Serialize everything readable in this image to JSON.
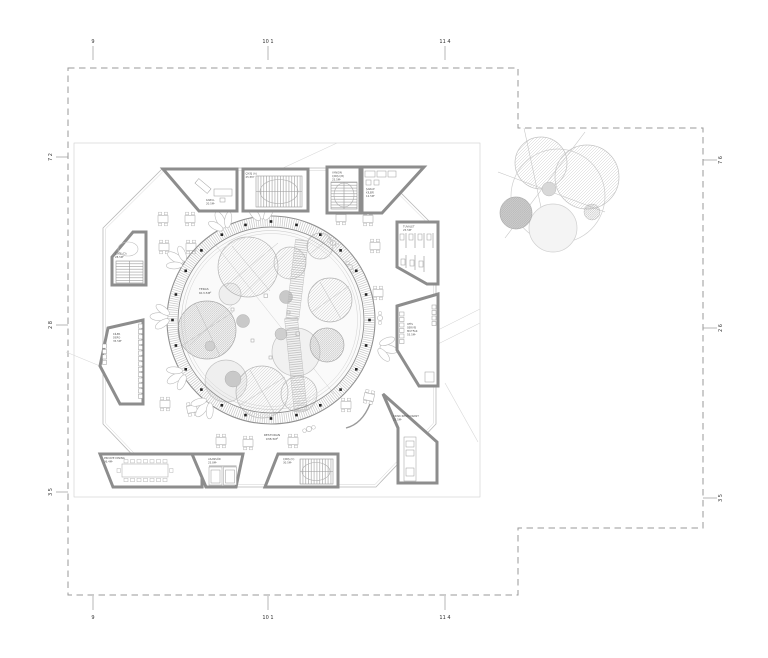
{
  "drawing": {
    "type": "architectural-floor-plan",
    "colors": {
      "background": "#ffffff",
      "walls": "#8d8d8d",
      "boundary_dash": "#9a9a9a",
      "columns": "#222222",
      "linework_light": "#c4c4c4",
      "text": "#555555"
    },
    "grid": {
      "top": [
        "9",
        "10 1",
        "11 4"
      ],
      "bottom": [
        "9",
        "10 1",
        "11 4"
      ],
      "left": [
        "7 2",
        "2 8",
        "3 5"
      ],
      "right": [
        "7 6",
        "2 6",
        "3 5"
      ]
    },
    "courtyard": {
      "column_count": 24,
      "label": [
        "TERAS",
        "613.5M²"
      ]
    },
    "hall_label": [
      "RESTORAN",
      "938.5M²"
    ],
    "labels": {
      "kabul": [
        "KABUL",
        "20.5M²"
      ],
      "cikis_a": [
        "ÇIKIŞ (A)",
        "25.5M²"
      ],
      "yangin": [
        "YANGIN",
        "ÇIKIŞI (B)",
        "25.5M²"
      ],
      "sarap": [
        "ŞARAP",
        "KİLERİ",
        "12.5M²"
      ],
      "tuvalet": [
        "TUVALET",
        "25.5M²"
      ],
      "mutfak": [
        "OFİS",
        "SERVİS",
        "MUTFAK",
        "55.5M²"
      ],
      "kiosk": [
        "KIOSK RESTAURANT",
        "25.5M²"
      ],
      "dining": [
        "PRIVATE DINING",
        "36.4M²"
      ],
      "asansor": [
        "ASANSÖR",
        "25.8M²"
      ],
      "cikis_c": [
        "ÇIKIŞ (C)",
        "30.5M²"
      ],
      "cikis_d": [
        "ÇIKIŞ (D)",
        "28.5M²"
      ],
      "depo": [
        "KİLER",
        "DEPO",
        "35.5M²"
      ]
    }
  }
}
